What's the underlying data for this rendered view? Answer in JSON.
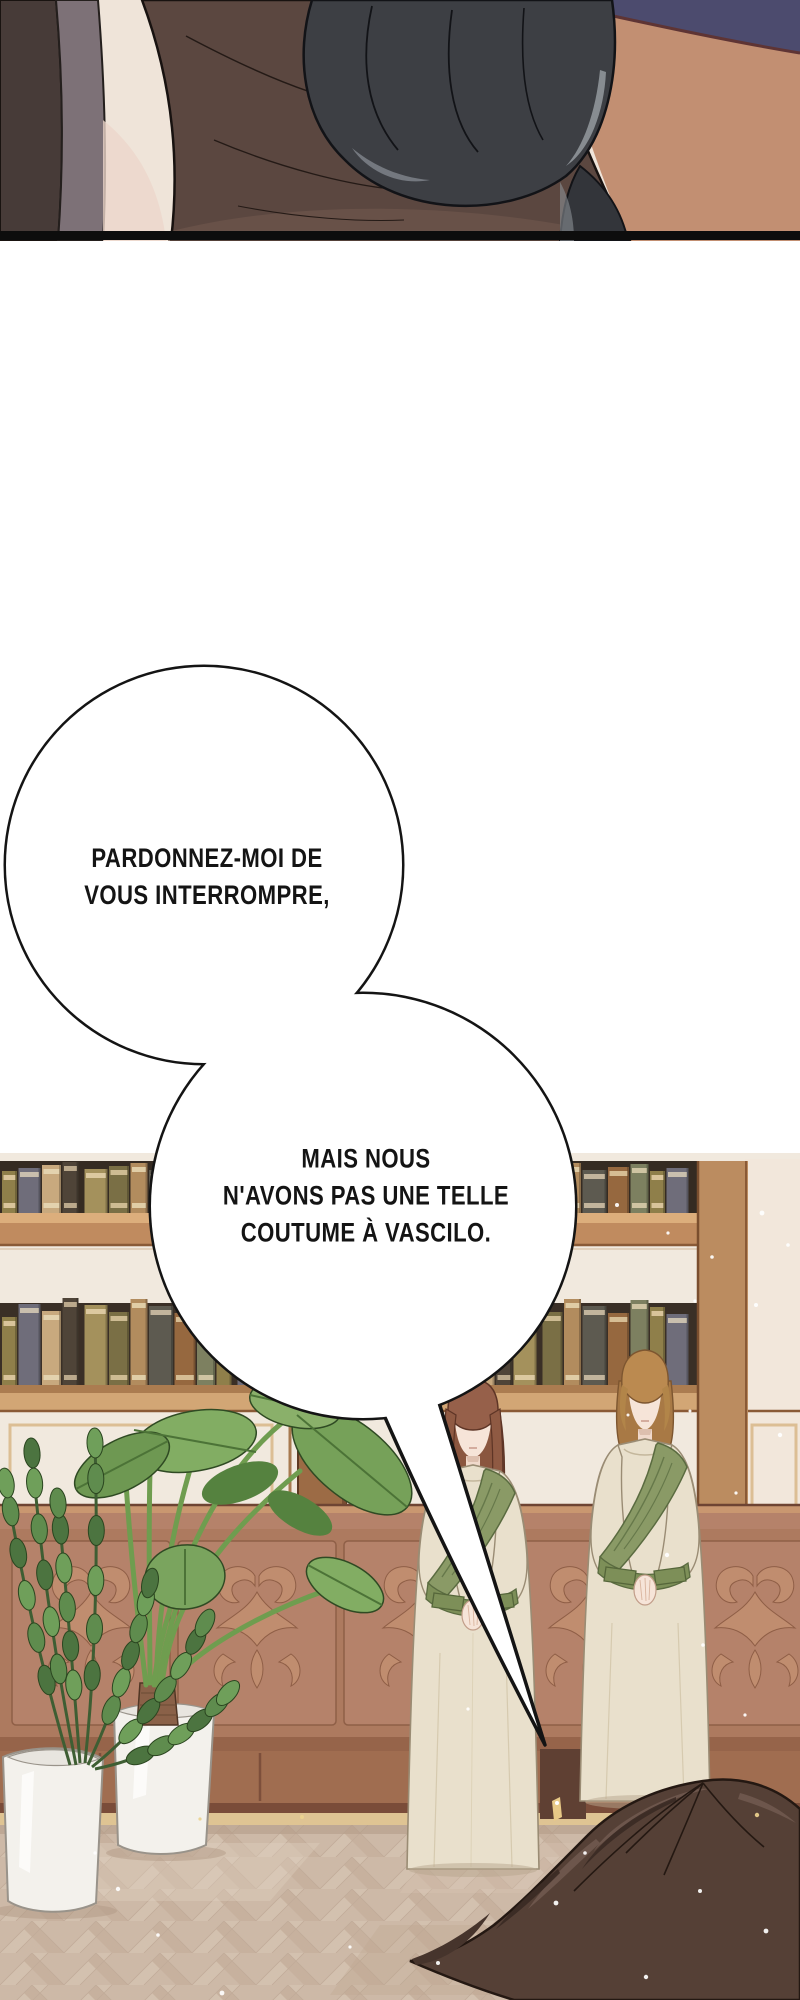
{
  "speech_bubbles": [
    {
      "id": "bubble-1",
      "text": "PARDONNEZ-MOI DE\nVOUS INTERROMPRE,"
    },
    {
      "id": "bubble-2",
      "text": "MAIS NOUS\nN'AVONS PAS UNE TELLE\nCOUTUME À VASCILO."
    }
  ],
  "colors": {
    "page_background": "#ffffff",
    "ink": "#141414",
    "bubble_fill": "#ffffff",
    "wall_cream": "#f1e9de",
    "shelf_wood": "#c08b5f",
    "shelf_wood_light": "#dcae7c",
    "pillar_wood": "#bb8c60",
    "cabinet_base": "#ad7a5f",
    "cabinet_carving": "#c18e70",
    "cabinet_dark": "#96644a",
    "baseboard_gold": "#dfc493",
    "floor_base": "#cdb9a7",
    "dress_cream": "#e9e0cc",
    "sash_green": "#8a9a66",
    "skin": "#f6e4d8",
    "hair_auburn": "#96604a",
    "hair_copper": "#b88c56",
    "hair_foreground": "#554036",
    "glove_gray": "#3d3f44",
    "jacket_brown": "#5b4740",
    "desk_tan": "#c28f72",
    "navy": "#4c4b6e",
    "leaf_green": "#7aa45e",
    "book_palette": [
      [
        "#8f7f4a",
        "#d9c49a"
      ],
      [
        "#6f6d7a",
        "#c9bfae"
      ],
      [
        "#c8a97e",
        "#e3d2ae"
      ],
      [
        "#4f4438",
        "#bba98c"
      ],
      [
        "#a4915c",
        "#dcc9a0"
      ],
      [
        "#7a6f45",
        "#cdbb92"
      ],
      [
        "#b28c5e",
        "#e0cda6"
      ],
      [
        "#5d5a50",
        "#c2b49c"
      ],
      [
        "#96683f",
        "#d6bd94"
      ],
      [
        "#7d8060",
        "#cfc4a2"
      ]
    ]
  }
}
